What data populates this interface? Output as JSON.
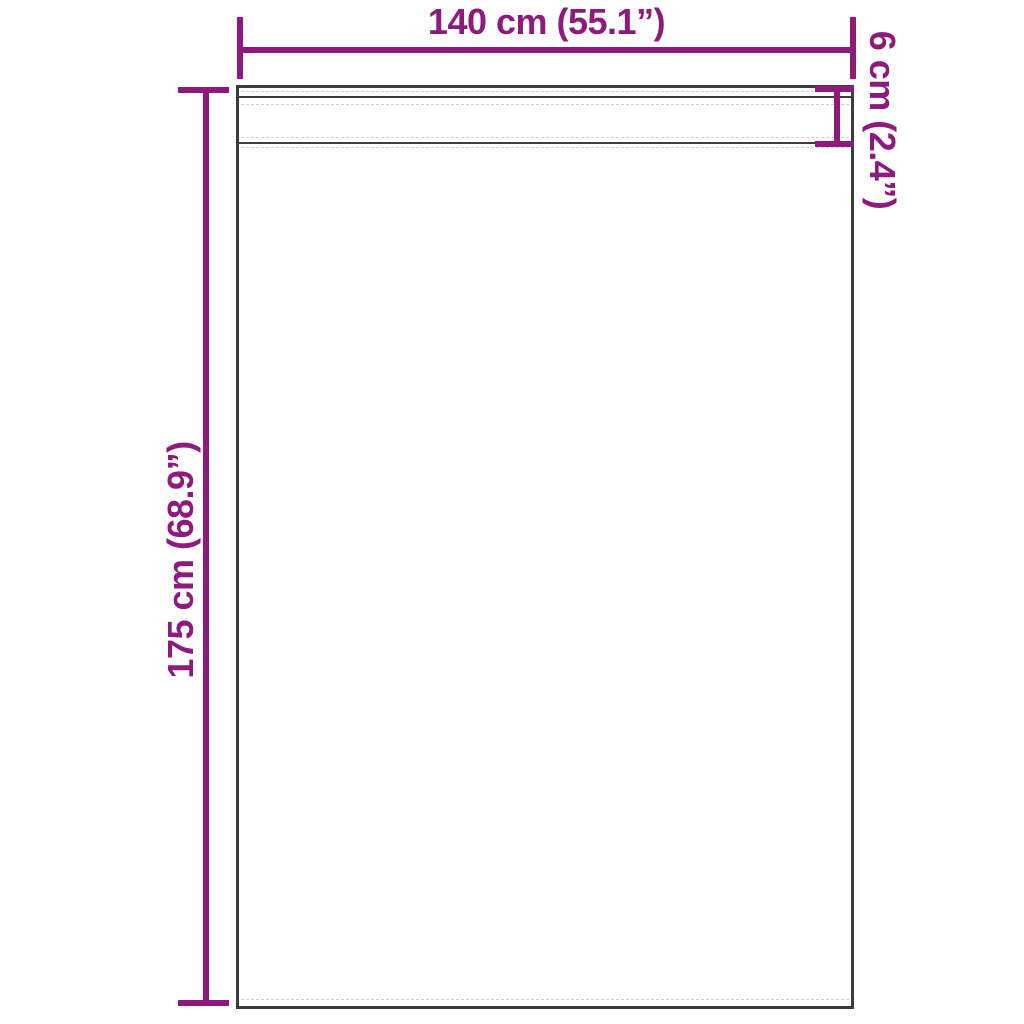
{
  "diagram": {
    "colors": {
      "accent": "#8e1a7e",
      "outline": "#3c3c3c",
      "stitch": "#cfcfcf",
      "bg": "#ffffff"
    },
    "dimensions": {
      "width": {
        "label": "140 cm (55.1”)"
      },
      "height": {
        "label": "175 cm (68.9”)"
      },
      "header": {
        "label": "6 cm (2.4”)"
      }
    }
  }
}
